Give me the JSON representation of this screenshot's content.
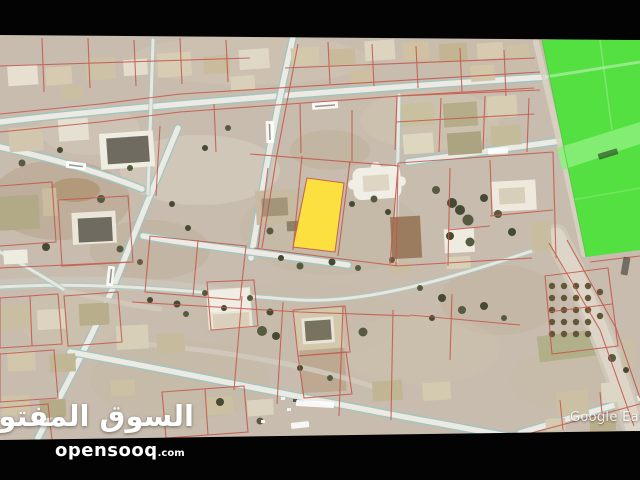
{
  "brand": {
    "arabic_wordmark": "السوق المفتوح",
    "latin_wordmark": "opensooq",
    "latin_tld": ".com"
  },
  "map": {
    "credit": "Google Earth",
    "colors": {
      "terrain": "#c8bcae",
      "highlight_parcel": "#ffe23a",
      "featured_area": "#4ee13c",
      "parcel_lines": "#c4564a",
      "road_edge": "#9cc6c2"
    }
  }
}
